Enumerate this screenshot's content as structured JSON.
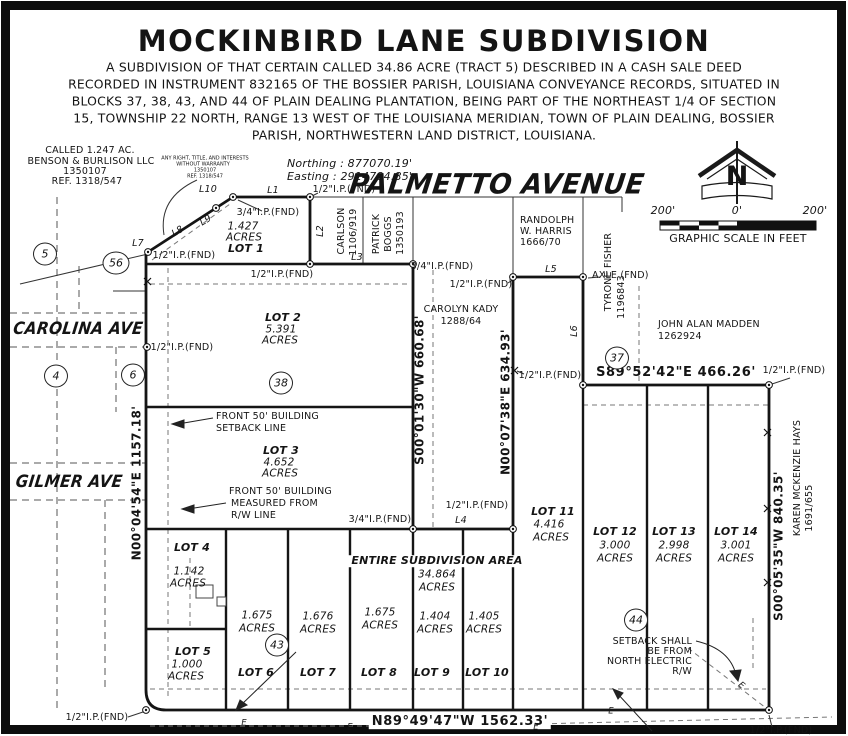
{
  "title": "MOCKINBIRD LANE SUBDIVISION",
  "subtitle_lines": [
    "A SUBDIVISION OF THAT CERTAIN CALLED 34.86 ACRE (TRACT 5) DESCRIBED IN A CASH SALE DEED",
    "RECORDED IN INSTRUMENT 832165 OF THE BOSSIER PARISH, LOUISIANA CONVEYANCE RECORDS, SITUATED IN",
    "BLOCKS 37, 38, 43, AND 44 OF PLAIN DEALING PLANTATION, BEING PART OF THE NORTHEAST 1/4 OF SECTION",
    "15, TOWNSHIP 22 NORTH, RANGE 13 WEST OF THE LOUISIANA MERIDIAN, TOWN OF PLAIN DEALING, BOSSIER",
    "PARISH, NORTHWESTERN LAND DISTRICT, LOUISIANA."
  ],
  "compass": {
    "n": "N"
  },
  "scale": {
    "left": "200'",
    "zero": "0'",
    "right": "200'",
    "caption": "GRAPHIC SCALE IN FEET"
  },
  "coords": {
    "northing": "Northing : 877070.19'",
    "easting": "Easting : 2914784.85'"
  },
  "streets": {
    "palmetto": "PALMETTO AVENUE",
    "carolina": "CAROLINA AVE",
    "gilmer": "GILMER AVE"
  },
  "owners": {
    "benson": [
      "CALLED 1.247 AC.",
      "BENSON & BURLISON LLC",
      "1350107",
      "REF. 1318/547"
    ],
    "benson_note": [
      "ANY RIGHT, TITLE, AND INTERESTS",
      "WITHOUT WARRANTY",
      "1350107",
      "REF. 1318/547"
    ],
    "carlson": [
      "CARLSON",
      "1106/919"
    ],
    "boggs": [
      "PATRICK",
      "BOGGS",
      "1350193"
    ],
    "harris": [
      "RANDOLPH",
      "W. HARRIS",
      "1666/70"
    ],
    "fisher": [
      "TYRONE FISHER",
      "1196843"
    ],
    "madden": [
      "JOHN ALAN MADDEN",
      "1262924"
    ],
    "kady": [
      "CAROLYN KADY",
      "1288/64"
    ],
    "hays": [
      "KAREN MCKENZIE HAYS",
      "1691/655"
    ]
  },
  "lots": {
    "lot1": {
      "label": "LOT 1",
      "acres": "1.427"
    },
    "lot2": {
      "label": "LOT 2",
      "acres": "5.391"
    },
    "lot3": {
      "label": "LOT 3",
      "acres": "4.652"
    },
    "lot4": {
      "label": "LOT 4",
      "acres": "1.142"
    },
    "lot5": {
      "label": "LOT 5",
      "acres": "1.000"
    },
    "lot6": {
      "label": "LOT 6",
      "acres": "1.675"
    },
    "lot7": {
      "label": "LOT 7",
      "acres": "1.676"
    },
    "lot8": {
      "label": "LOT 8",
      "acres": "1.675"
    },
    "lot9": {
      "label": "LOT 9",
      "acres": "1.404"
    },
    "lot10": {
      "label": "LOT 10",
      "acres": "1.405"
    },
    "lot11": {
      "label": "LOT 11",
      "acres": "4.416"
    },
    "lot12": {
      "label": "LOT 12",
      "acres": "3.000"
    },
    "lot13": {
      "label": "LOT 13",
      "acres": "2.998"
    },
    "lot14": {
      "label": "LOT 14",
      "acres": "3.001"
    }
  },
  "acres_word": "ACRES",
  "entire": {
    "line1": "ENTIRE SUBDIVISION AREA",
    "acres": "34.864"
  },
  "blocks": {
    "b5": "5",
    "b56": "56",
    "b4": "4",
    "b6": "6",
    "b37": "37",
    "b38": "38",
    "b43": "43",
    "b44": "44"
  },
  "bearings": {
    "west": "N00°04'54\"E  1157.18'",
    "kady_west": "S00°01'30\"W  660.68'",
    "kady_east": "N00°07'38\"E  634.93'",
    "north_right": "S89°52'42\"E   466.26'",
    "east": "S00°05'35\"W  840.35'",
    "south": "N89°49'47\"W   1562.33'"
  },
  "line_labels": {
    "l1": "L1",
    "l2": "L2",
    "l3": "L3",
    "l4": "L4",
    "l5": "L5",
    "l6": "L6",
    "l7": "L7",
    "l8": "L8",
    "l9": "L9",
    "l10": "L10"
  },
  "monuments": {
    "half_ip": "1/2\"I.P.(FND)",
    "three_quarter_ip": "3/4\"I.P.(FND)",
    "axle": "AXLE (FND)"
  },
  "notes": {
    "setback_front": [
      "FRONT 50' BUILDING",
      "SETBACK LINE"
    ],
    "setback_rw": [
      "FRONT 50' BUILDING",
      "MEASURED FROM",
      "R/W LINE"
    ],
    "setback_electric": [
      "SETBACK SHALL",
      "BE FROM",
      "NORTH ELECTRIC",
      "R/W"
    ],
    "e_marker": "E"
  }
}
